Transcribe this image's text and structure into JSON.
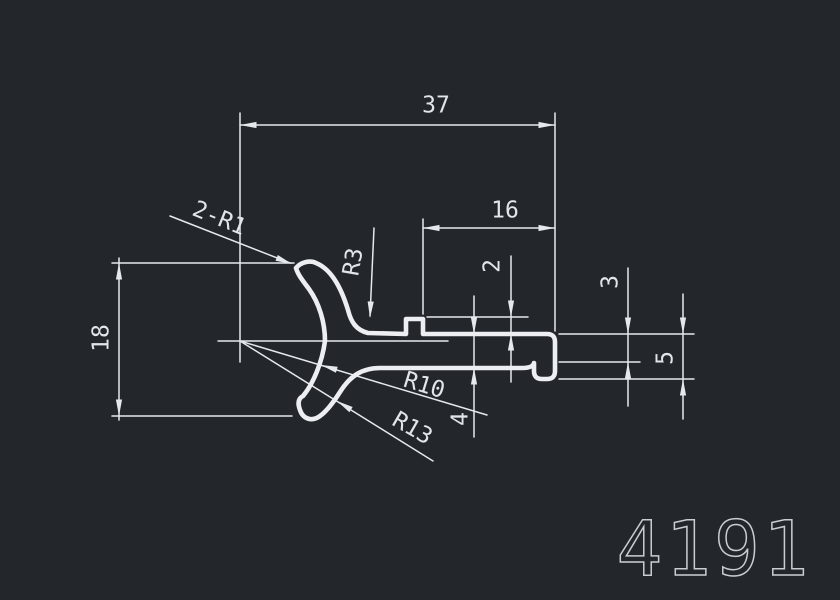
{
  "colors": {
    "background": "#23272c",
    "line": "#e6e9ec",
    "text": "#e2e5e9",
    "part_number": "#c9ccd1"
  },
  "part_number": "4191",
  "labels": {
    "d37": "37",
    "d16": "16",
    "d18": "18",
    "d2": "2",
    "d3": "3",
    "d4": "4",
    "d5": "5",
    "r3": "R3",
    "r10": "R10",
    "r13": "R13",
    "r2r1": "2-R1"
  },
  "dimensions": [
    {
      "label": "37",
      "kind": "linear-horizontal",
      "meaning": "overall width from arc center to right end"
    },
    {
      "label": "16",
      "kind": "linear-horizontal",
      "meaning": "notch to right end"
    },
    {
      "label": "18",
      "kind": "linear-vertical",
      "meaning": "overall height of hook"
    },
    {
      "label": "2",
      "kind": "linear-vertical",
      "meaning": "notch step height"
    },
    {
      "label": "4",
      "kind": "linear-vertical",
      "meaning": "flange thickness"
    },
    {
      "label": "3",
      "kind": "linear-vertical",
      "meaning": "lip inner depth"
    },
    {
      "label": "5",
      "kind": "linear-vertical",
      "meaning": "lip overall depth"
    },
    {
      "label": "2-R1",
      "kind": "radius-leader",
      "meaning": "two corner radii R1"
    },
    {
      "label": "R3",
      "kind": "radius-leader",
      "meaning": "fillet radius"
    },
    {
      "label": "R10",
      "kind": "radius-leader",
      "meaning": "inner claw radius"
    },
    {
      "label": "R13",
      "kind": "radius-leader",
      "meaning": "outer claw radius"
    }
  ]
}
